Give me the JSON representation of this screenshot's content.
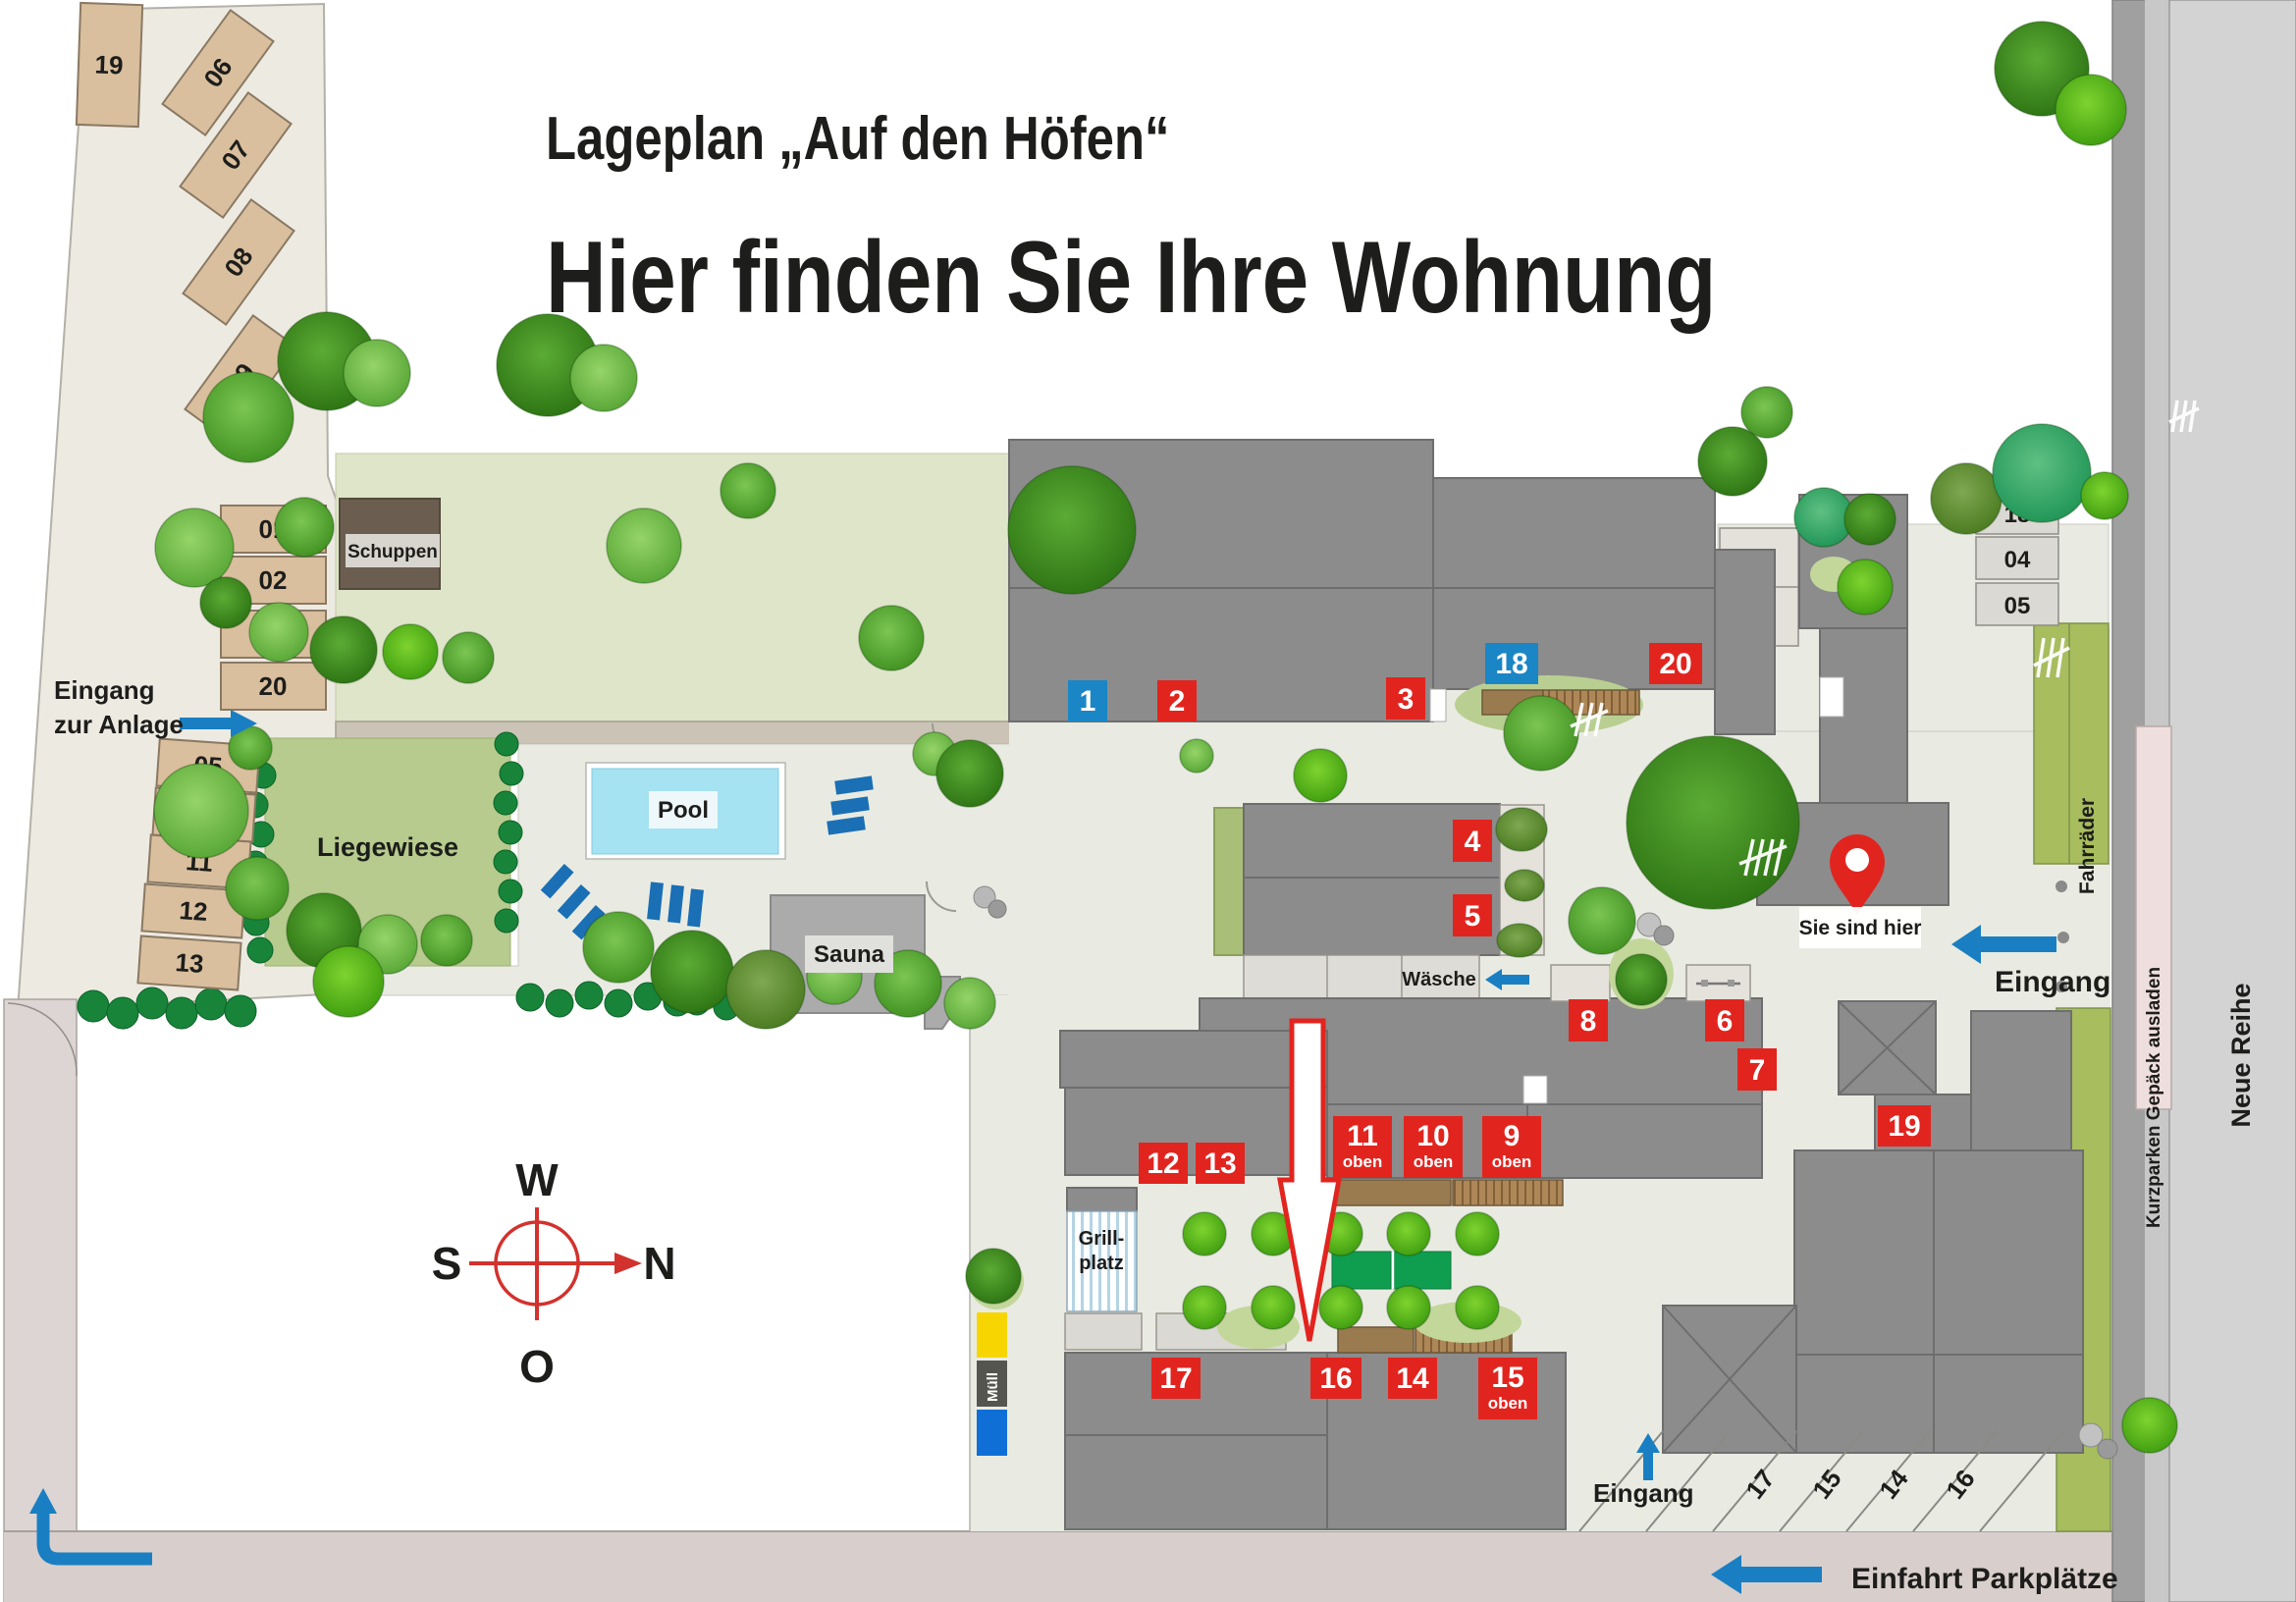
{
  "title": {
    "line1": "Lageplan „Auf den Höfen“",
    "line2": "Hier finden Sie Ihre Wohnung"
  },
  "markers": [
    {
      "label": "1",
      "color": "#1b86c5"
    },
    {
      "label": "2",
      "color": "#e2241f"
    },
    {
      "label": "3",
      "color": "#e2241f"
    },
    {
      "label": "18",
      "color": "#1b86c5"
    },
    {
      "label": "20",
      "color": "#e2241f"
    },
    {
      "label": "4",
      "color": "#e2241f"
    },
    {
      "label": "5",
      "color": "#e2241f"
    },
    {
      "label": "8",
      "color": "#e2241f"
    },
    {
      "label": "6",
      "color": "#e2241f"
    },
    {
      "label": "7",
      "color": "#e2241f"
    },
    {
      "label": "12",
      "color": "#e2241f"
    },
    {
      "label": "13",
      "color": "#e2241f"
    },
    {
      "label": "11",
      "sub": "oben",
      "color": "#e2241f"
    },
    {
      "label": "10",
      "sub": "oben",
      "color": "#e2241f"
    },
    {
      "label": "9",
      "sub": "oben",
      "color": "#e2241f"
    },
    {
      "label": "19",
      "color": "#e2241f"
    },
    {
      "label": "17",
      "color": "#e2241f"
    },
    {
      "label": "16",
      "color": "#e2241f"
    },
    {
      "label": "14",
      "color": "#e2241f"
    },
    {
      "label": "15",
      "sub": "oben",
      "color": "#e2241f"
    }
  ],
  "parking": {
    "nw": [
      "19",
      "06",
      "07",
      "08",
      "09"
    ],
    "col": [
      "01",
      "02",
      "03",
      "20"
    ],
    "west": [
      "05",
      "10",
      "11",
      "12",
      "13"
    ],
    "east": [
      "18",
      "04",
      "05"
    ],
    "south": [
      "17",
      "15",
      "14",
      "16"
    ]
  },
  "labels": {
    "eingang_anlage_1": "Eingang",
    "eingang_anlage_2": "zur Anlage",
    "liegewiese": "Liegewiese",
    "pool": "Pool",
    "sauna": "Sauna",
    "schuppen": "Schuppen",
    "waesche": "Wäsche",
    "muell": "Müll",
    "grill_1": "Grill-",
    "grill_2": "platz",
    "sie_sind_hier": "Sie sind hier",
    "eingang_right": "Eingang",
    "eingang_bottom": "Eingang",
    "fahrraeder": "Fahrräder",
    "kurzparken": "Kurzparken Gepäck ausladen",
    "neue_reihe": "Neue Reihe",
    "einfahrt": "Einfahrt Parkplätze"
  },
  "compass": {
    "w": "W",
    "n": "N",
    "s": "S",
    "o": "O"
  },
  "colors": {
    "marker_red": "#e2241f",
    "marker_blue": "#1b86c5",
    "arrow_blue": "#1a7fc2",
    "building_gray": "#8c8c8c",
    "lawn_green": "#dee5c8",
    "meadow_green": "#b6cb8d",
    "pool_blue": "#a5e2f2",
    "stall_tan": "#d9bf9e"
  }
}
